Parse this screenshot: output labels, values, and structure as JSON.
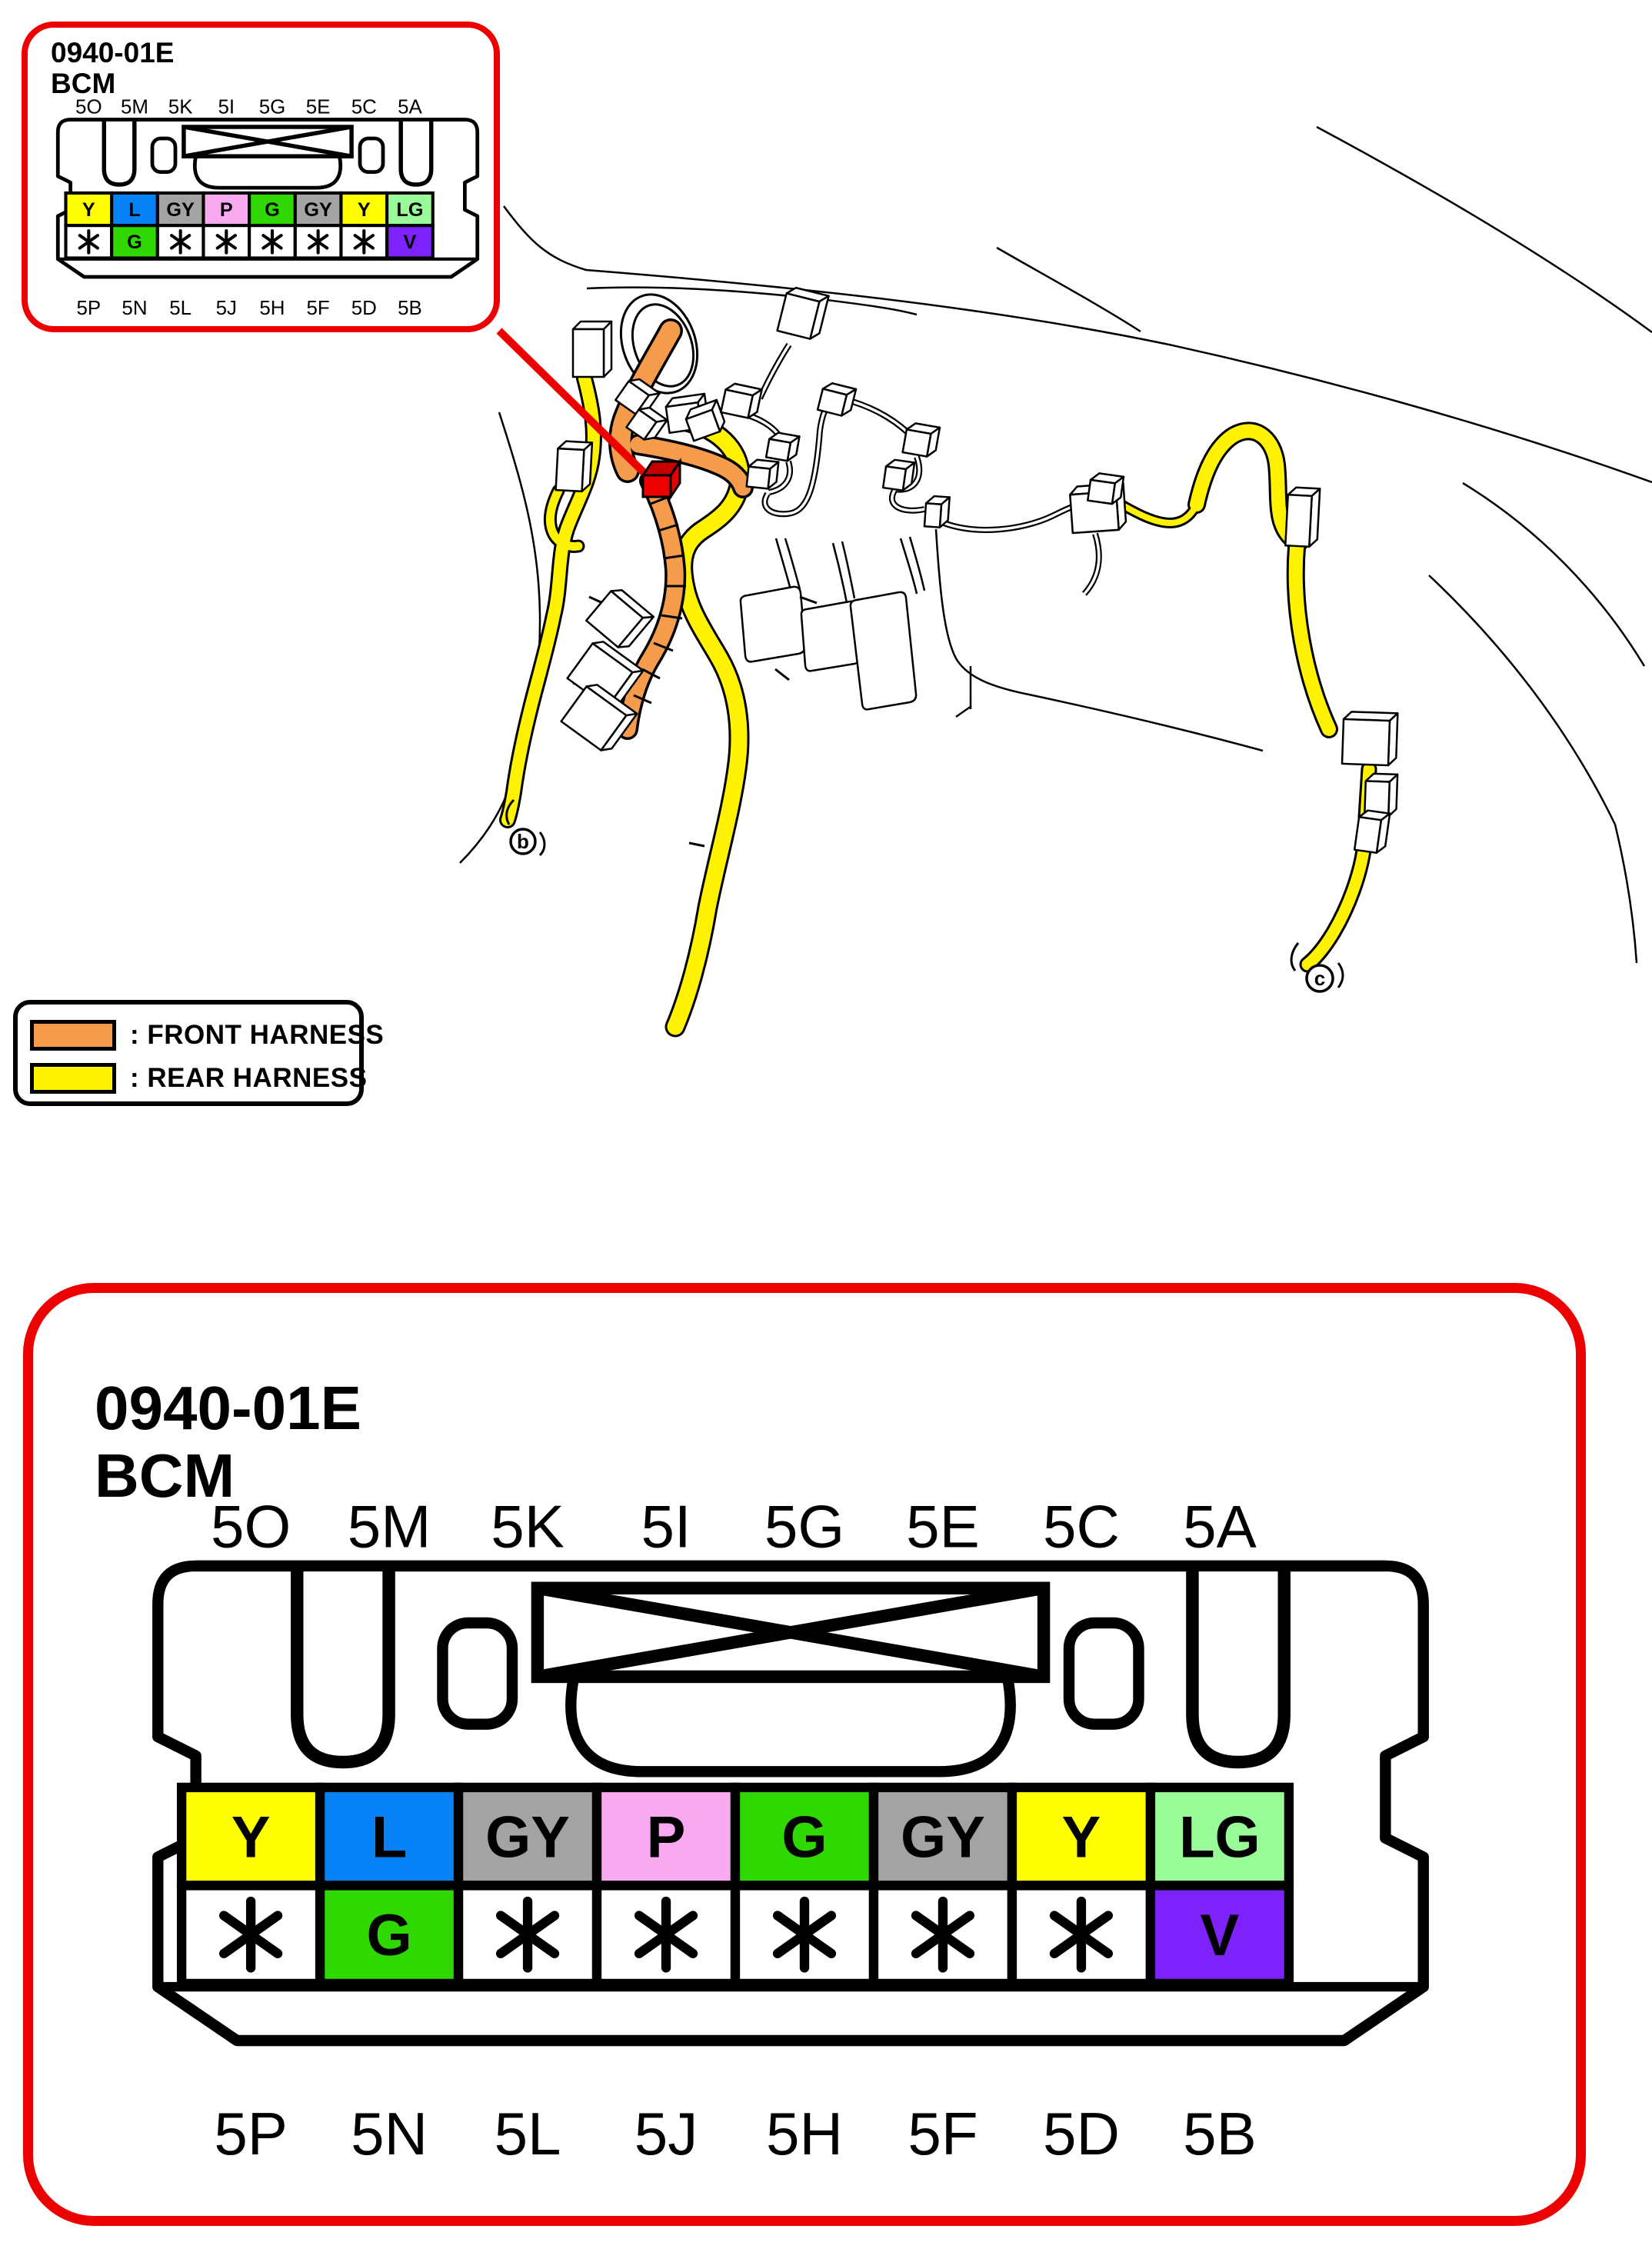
{
  "connector": {
    "id": "0940-01E",
    "name": "BCM",
    "top_pins": [
      "5O",
      "5M",
      "5K",
      "5I",
      "5G",
      "5E",
      "5C",
      "5A"
    ],
    "bottom_pins": [
      "5P",
      "5N",
      "5L",
      "5J",
      "5H",
      "5F",
      "5D",
      "5B"
    ],
    "top_row_cells": [
      {
        "label": "Y",
        "color": "#ffff00"
      },
      {
        "label": "L",
        "color": "#0682f6"
      },
      {
        "label": "GY",
        "color": "#a3a3a3"
      },
      {
        "label": "P",
        "color": "#f9a9f0"
      },
      {
        "label": "G",
        "color": "#2fd800"
      },
      {
        "label": "GY",
        "color": "#a3a3a3"
      },
      {
        "label": "Y",
        "color": "#ffff00"
      },
      {
        "label": "LG",
        "color": "#98fb98"
      }
    ],
    "bottom_row_cells": [
      {
        "label": "*",
        "color": "#ffffff"
      },
      {
        "label": "G",
        "color": "#2fd800"
      },
      {
        "label": "*",
        "color": "#ffffff"
      },
      {
        "label": "*",
        "color": "#ffffff"
      },
      {
        "label": "*",
        "color": "#ffffff"
      },
      {
        "label": "*",
        "color": "#ffffff"
      },
      {
        "label": "*",
        "color": "#ffffff"
      },
      {
        "label": "V",
        "color": "#7d22fa"
      }
    ]
  },
  "legend": {
    "items": [
      {
        "label": ": FRONT HARNESS",
        "color": "#f59b4c"
      },
      {
        "label": ": REAR HARNESS",
        "color": "#fff200"
      }
    ]
  },
  "markers": {
    "left": "b",
    "right": "c"
  },
  "colors": {
    "callout_red": "#ec0000",
    "front_harness": "#f59b4c",
    "rear_harness": "#fff200"
  }
}
